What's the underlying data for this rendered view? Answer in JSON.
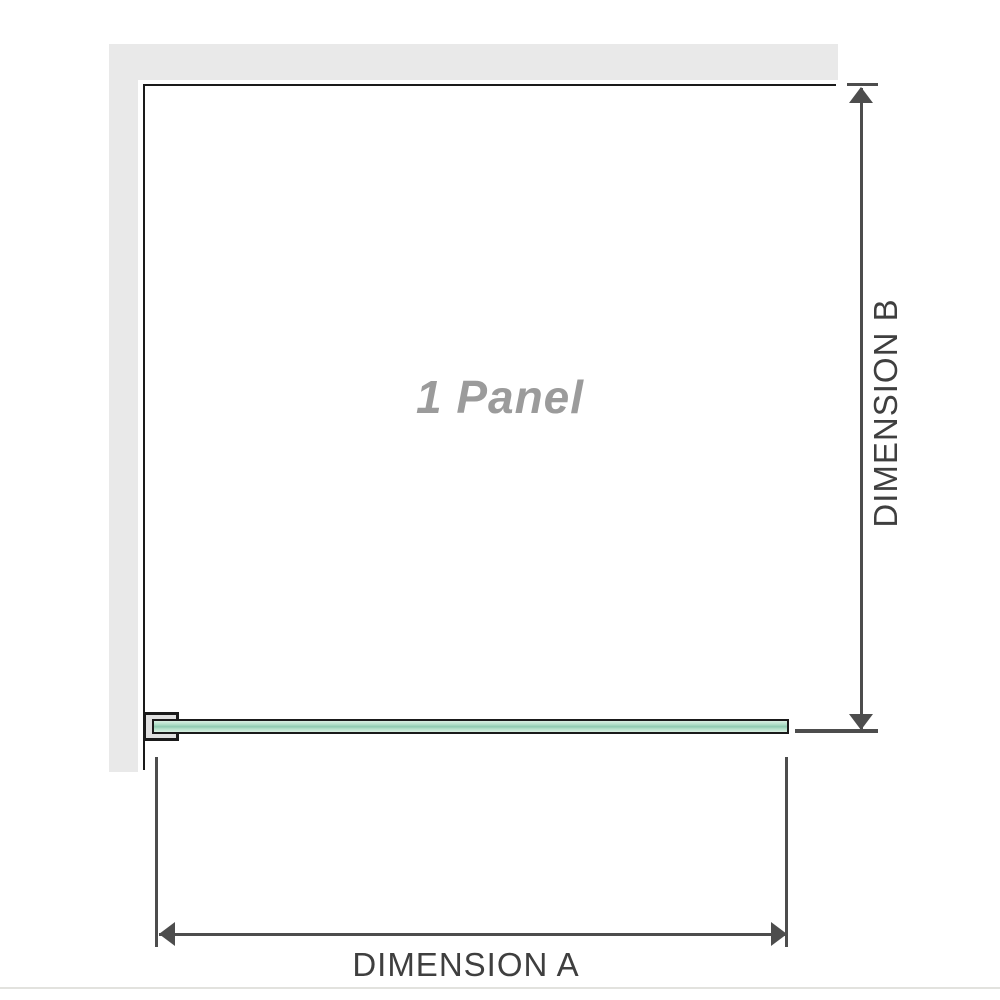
{
  "diagram": {
    "panel_label": "1 Panel",
    "dimension_a_label": "DIMENSION A",
    "dimension_b_label": "DIMENSION B"
  },
  "colors": {
    "background": "#ffffff",
    "wall_fill": "#e9e9e9",
    "panel_outline": "#1a1a1a",
    "glass_fill": "#b2e0c9",
    "glass_highlight": "#d9efe2",
    "glass_core": "#8fcbb1",
    "bracket_fill": "#e0e0e0",
    "dimension_line": "#4d4d4d",
    "dimension_text": "#3f3f3f",
    "panel_label_text": "#9b9b9b"
  }
}
